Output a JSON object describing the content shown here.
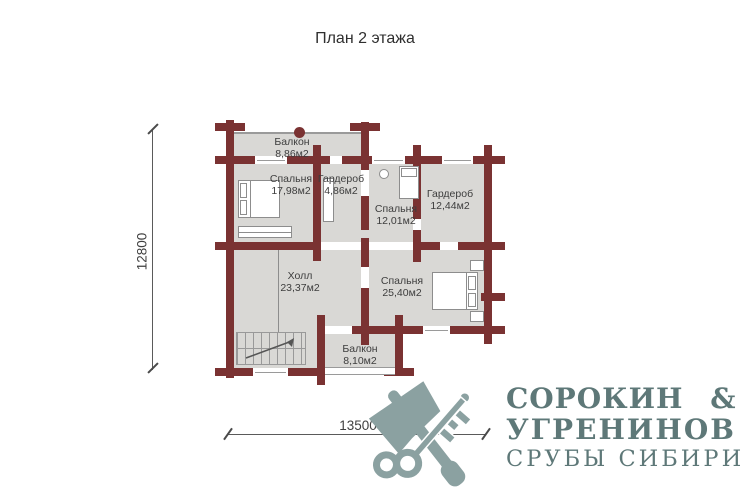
{
  "title": "План 2 этажа",
  "rooms": [
    {
      "name": "Балкон",
      "area": "8,86м2"
    },
    {
      "name": "Спальня",
      "area": "17,98м2"
    },
    {
      "name": "Гардероб",
      "area": "4,86м2"
    },
    {
      "name": "Спальня",
      "area": "12,01м2"
    },
    {
      "name": "Гардероб",
      "area": "12,44м2"
    },
    {
      "name": "Холл",
      "area": "23,37м2"
    },
    {
      "name": "Спальня",
      "area": "25,40м2"
    },
    {
      "name": "Балкон",
      "area": "8,10м2"
    }
  ],
  "dimensions": {
    "vertical": "12800",
    "horizontal": "13500"
  },
  "logo": {
    "line1": "СОРОКИН &",
    "line2": "УГРЕНИНОВ",
    "line3": "СРУБЫ СИБИРИ",
    "icon_name": "crossed-axe-and-key"
  },
  "colors": {
    "wall": "#7a3232",
    "floor": "#d9d8d5",
    "logo_text": "#5e7878",
    "logo_icon": "#8ba1a1",
    "dimension": "#4a4a4a"
  }
}
